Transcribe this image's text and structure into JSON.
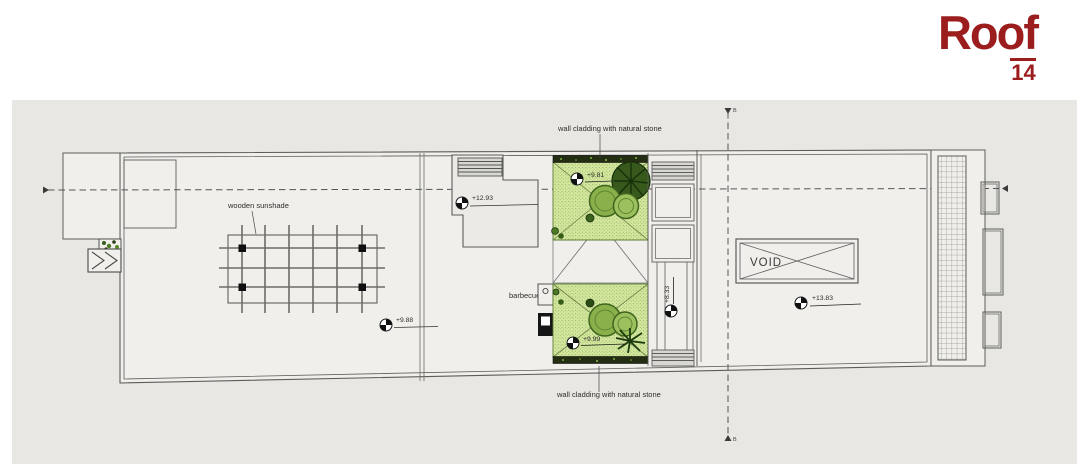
{
  "header": {
    "brand": "Roof",
    "brand_number": "14",
    "brand_color": "#9c1d1d"
  },
  "plan": {
    "labels": {
      "wooden_sunshade": "wooden sunshade",
      "wall_cladding_top": "wall cladding with natural stone",
      "wall_cladding_bottom": "wall cladding with natural stone",
      "barbecue": "barbecue",
      "void": "VOID"
    },
    "elevations": [
      {
        "value": "+12.93"
      },
      {
        "value": "+9.81"
      },
      {
        "value": "+9.88"
      },
      {
        "value": "+9.99"
      },
      {
        "value": "+8.33"
      },
      {
        "value": "+13.83"
      }
    ],
    "section_markers": {
      "top": "B",
      "bottom": "B"
    },
    "colors": {
      "planting_fill": "#d3e79f",
      "stone_strip": "#232d12",
      "line": "#5c5c5a",
      "panel": "#e8e7e4",
      "building": "#f0efec",
      "brand_red": "#9c1d1d"
    }
  }
}
